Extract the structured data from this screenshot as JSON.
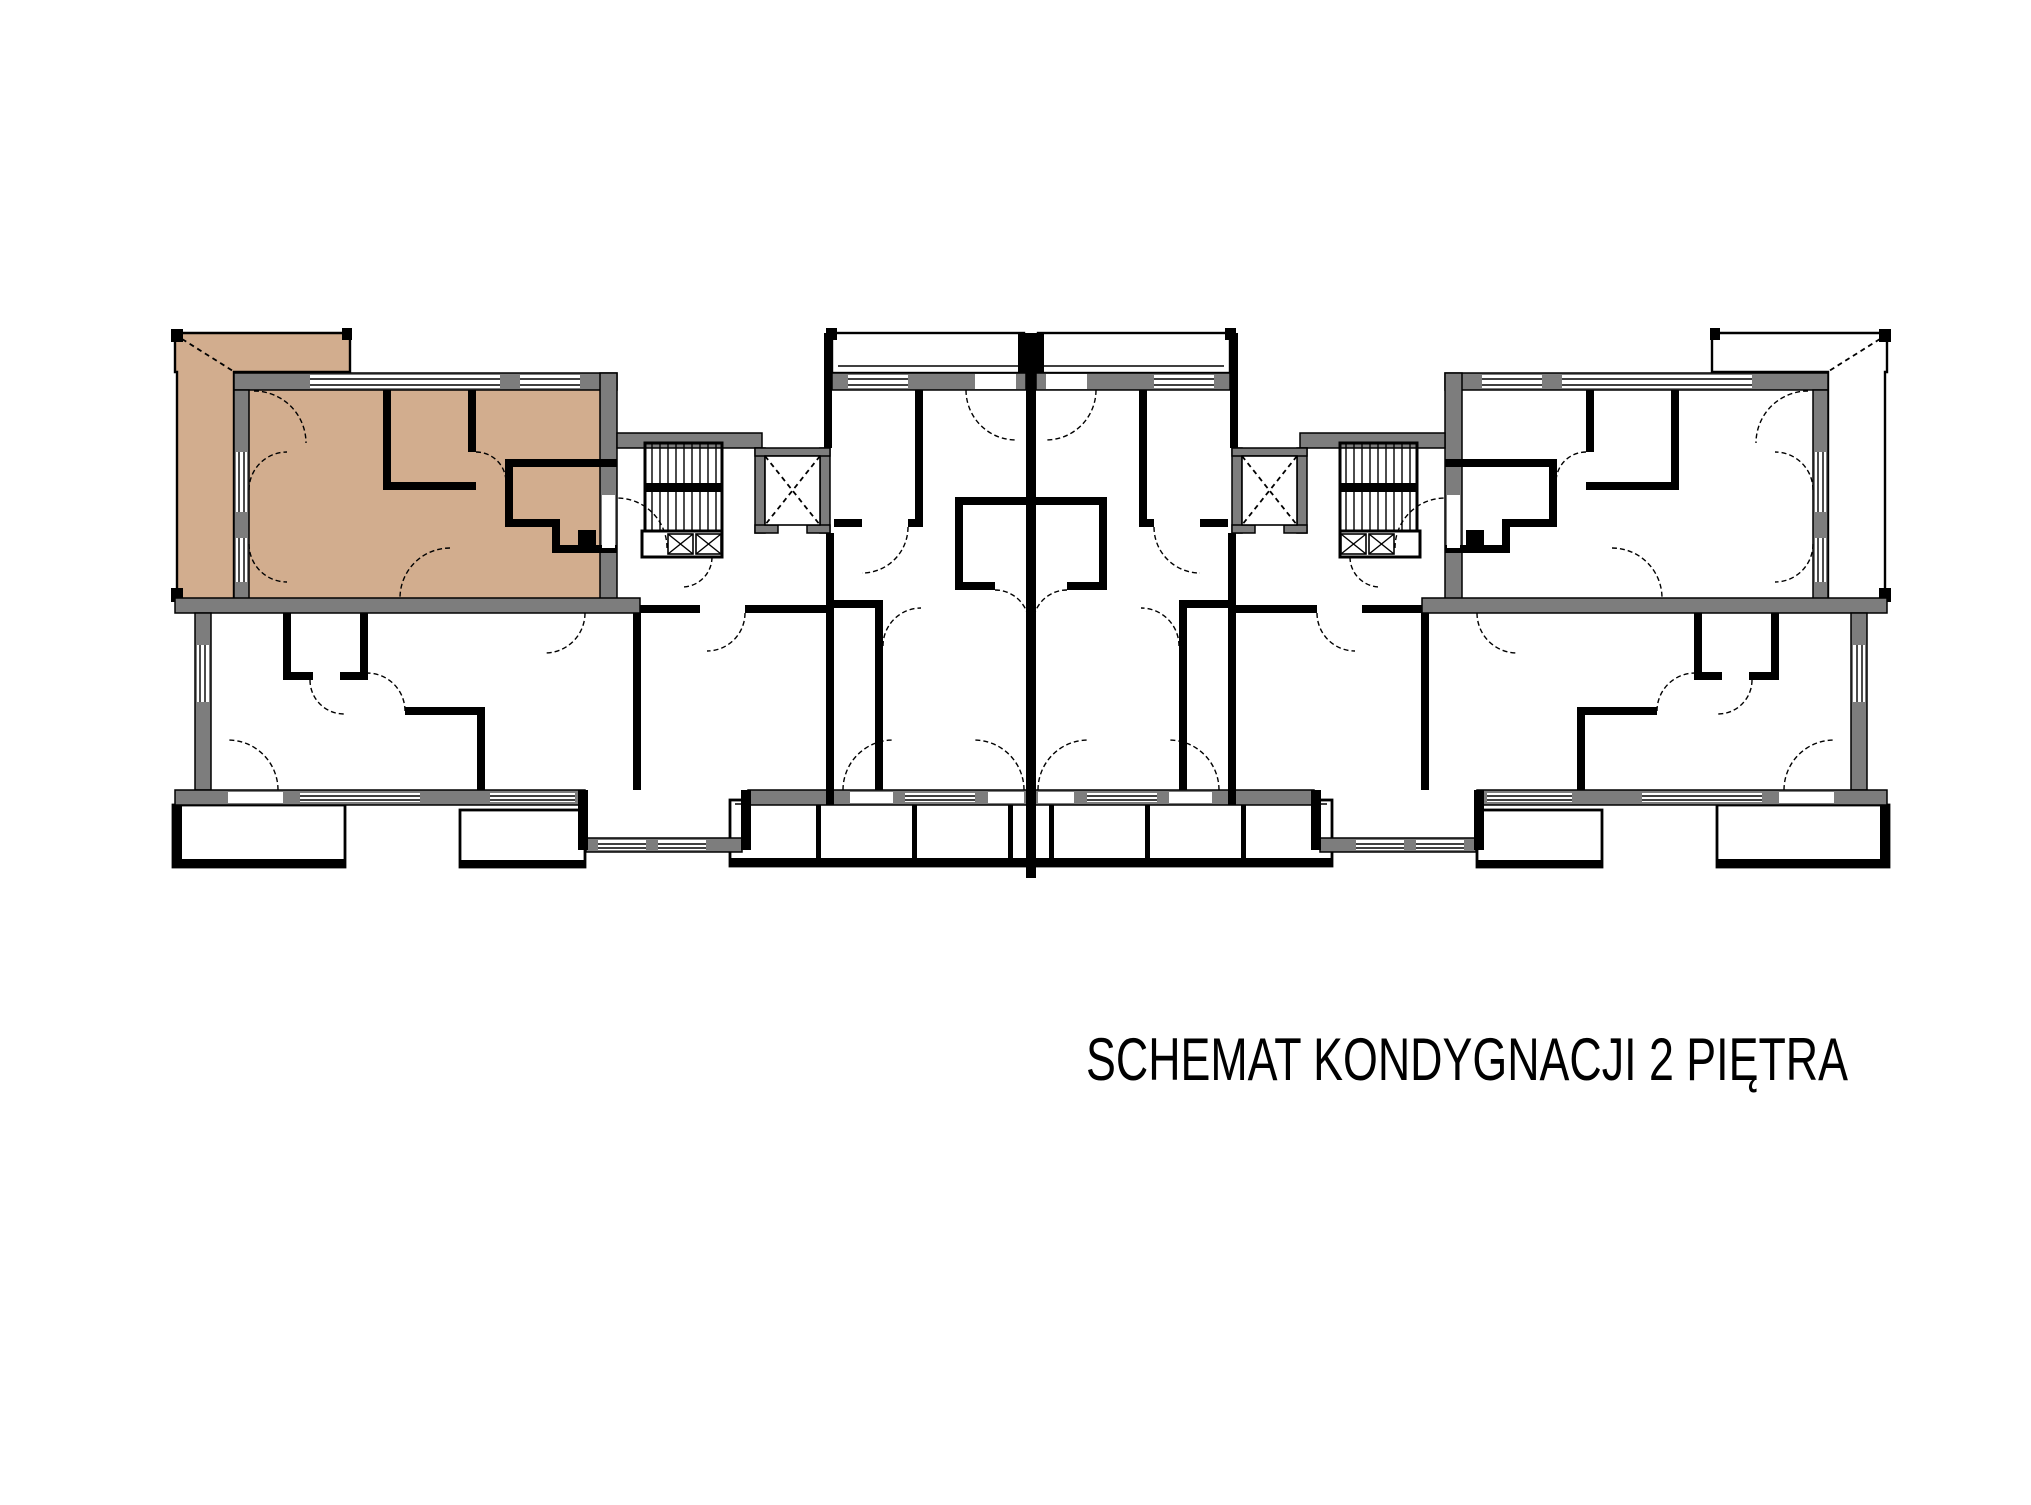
{
  "title": {
    "text": "SCHEMAT KONDYGNACJI 2 PIĘTRA"
  },
  "colors": {
    "highlight": "#d2ad8e",
    "wall": "#7d7d7d",
    "line": "#000000",
    "floor": "#ffffff"
  },
  "plan": {
    "type": "floor-plan",
    "floor_label": "2 PIĘTRA",
    "highlighted_unit": "top-left-apartment",
    "cores": [
      "staircase-left",
      "elevator-left",
      "staircase-right",
      "elevator-right"
    ],
    "balcony_rows": [
      "top-left",
      "top-center",
      "top-right",
      "bottom"
    ]
  }
}
